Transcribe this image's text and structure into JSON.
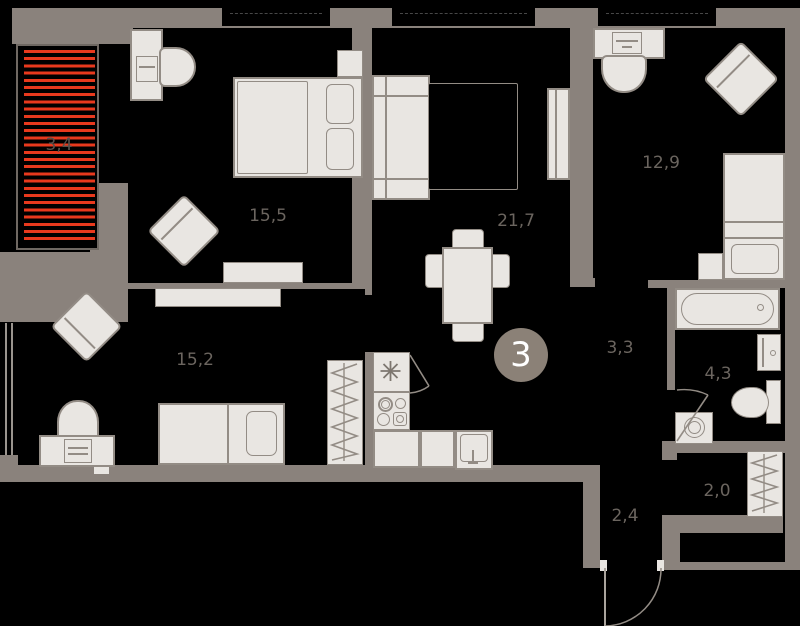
{
  "plan": {
    "unit_number": "3",
    "rooms": [
      {
        "id": "balcony",
        "area": "3,4"
      },
      {
        "id": "bedroom-top",
        "area": "15,5"
      },
      {
        "id": "living-kitchen",
        "area": "21,7"
      },
      {
        "id": "bedroom-right",
        "area": "12,9"
      },
      {
        "id": "hall",
        "area": "3,3"
      },
      {
        "id": "bathroom",
        "area": "4,3"
      },
      {
        "id": "storage",
        "area": "2,0"
      },
      {
        "id": "entry-corridor",
        "area": "2,4"
      },
      {
        "id": "bedroom-bottom",
        "area": "15,2"
      }
    ],
    "colors": {
      "wall": "#8a827c",
      "floor": "#000000",
      "furniture": "#e9e6e2",
      "furniture_outline": "#938c85",
      "balcony_stripe": "#e8391d",
      "label": "#6b655f",
      "badge_background": "#8b8177",
      "badge_text": "#ffffff"
    }
  }
}
